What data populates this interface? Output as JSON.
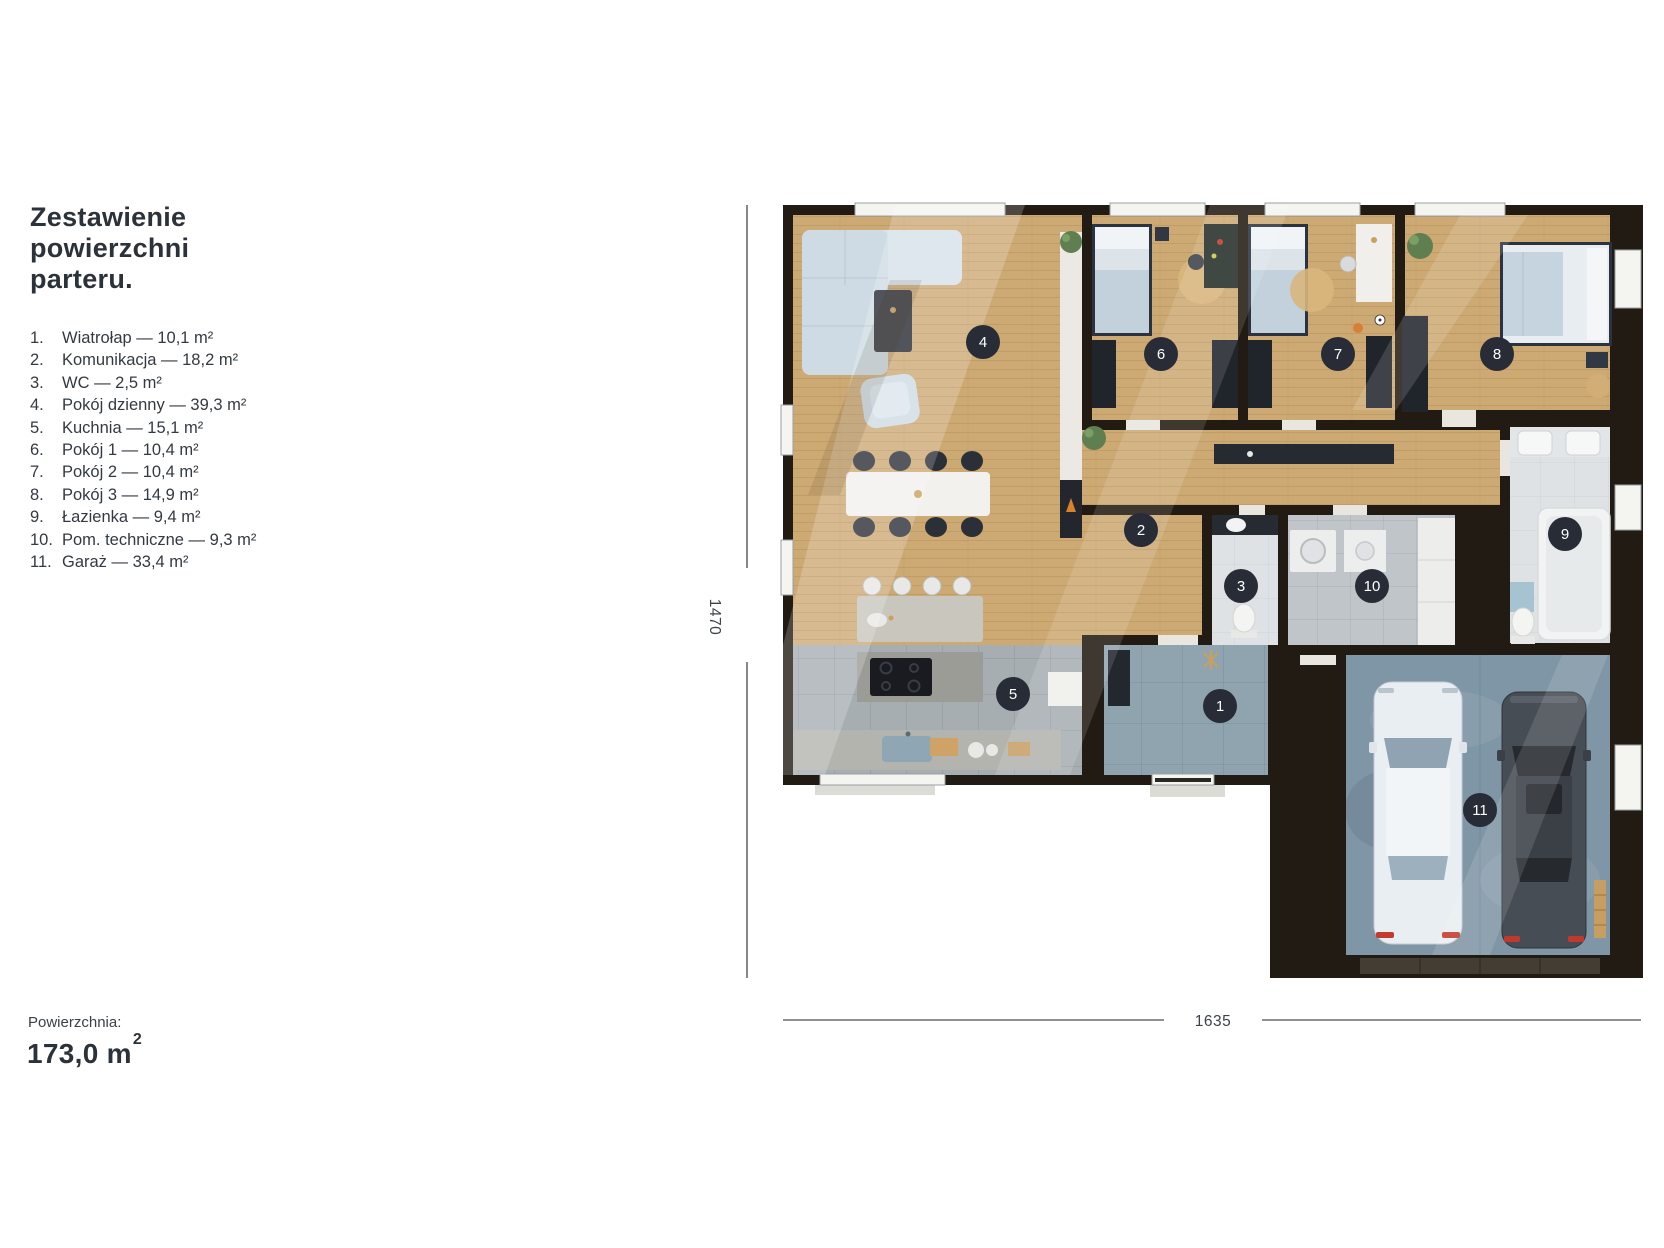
{
  "panel": {
    "title": "Zestawienie powierzchni parteru.",
    "rooms": [
      {
        "num": "1.",
        "label": "Wiatrołap — 10,1 m²"
      },
      {
        "num": "2.",
        "label": "Komunikacja — 18,2 m²"
      },
      {
        "num": "3.",
        "label": "WC — 2,5 m²"
      },
      {
        "num": "4.",
        "label": "Pokój dzienny — 39,3 m²"
      },
      {
        "num": "5.",
        "label": "Kuchnia — 15,1 m²"
      },
      {
        "num": "6.",
        "label": "Pokój 1 — 10,4 m²"
      },
      {
        "num": "7.",
        "label": "Pokój 2 — 10,4 m²"
      },
      {
        "num": "8.",
        "label": "Pokój 3 — 14,9 m²"
      },
      {
        "num": "9.",
        "label": "Łazienka — 9,4 m²"
      },
      {
        "num": "10.",
        "label": "Pom. techniczne — 9,3 m²"
      },
      {
        "num": "11.",
        "label": "Garaż — 33,4 m²"
      }
    ],
    "area_label": "Powierzchnia:",
    "area_value": "173,0 m",
    "area_value_sup": "2"
  },
  "plan": {
    "dim_height": "1470",
    "dim_width": "1635",
    "badges": [
      {
        "num": "1",
        "x": 530,
        "y": 516
      },
      {
        "num": "2",
        "x": 451,
        "y": 340
      },
      {
        "num": "3",
        "x": 551,
        "y": 396
      },
      {
        "num": "4",
        "x": 293,
        "y": 152
      },
      {
        "num": "5",
        "x": 323,
        "y": 504
      },
      {
        "num": "6",
        "x": 471,
        "y": 164
      },
      {
        "num": "7",
        "x": 648,
        "y": 164
      },
      {
        "num": "8",
        "x": 807,
        "y": 164
      },
      {
        "num": "9",
        "x": 875,
        "y": 344
      },
      {
        "num": "10",
        "x": 682,
        "y": 396
      },
      {
        "num": "11",
        "x": 790,
        "y": 620
      }
    ]
  },
  "colors": {
    "text": "#2b3239",
    "badge": "#272c36",
    "wall": "#221b13",
    "wood_floor": "#cda973",
    "kitchen_tile": "#a7aeb2",
    "entry_tile": "#90a4af",
    "garage_concrete": "#7f96a6",
    "dimension_line": "#6b6b6b"
  }
}
